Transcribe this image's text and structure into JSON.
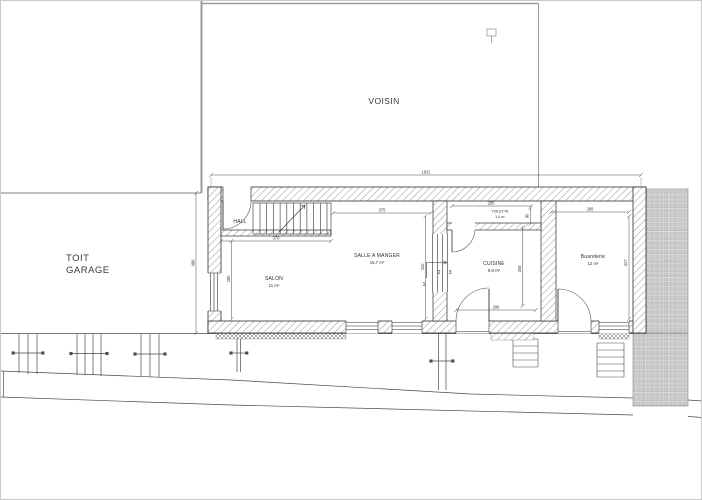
{
  "labels": {
    "voisin": "VOISIN",
    "toit_line1": "TOIT",
    "toit_line2": "GARAGE"
  },
  "rooms": {
    "hall": {
      "name": "HALL"
    },
    "salon": {
      "name": "SALON",
      "area": "11 m²"
    },
    "salle_a_manger": {
      "name": "SALLE A MANGER",
      "area": "15,7 m²"
    },
    "toilette": {
      "name": "TOILETTE",
      "area": "1,4 m²"
    },
    "cuisine": {
      "name": "CUISINE",
      "area": "9,8 m²"
    },
    "buanderie": {
      "name": "Buanderie",
      "area": "12 m²"
    }
  },
  "dims": {
    "total_width": "1931",
    "left_height": "488",
    "hall_bottom": "370",
    "salon_height": "280",
    "salle_top": "375",
    "salle_height": "410",
    "toilette_width": "295",
    "toilette_height": "90",
    "cuisine_width": "296",
    "cuisine_height": "308",
    "buanderie_width": "288",
    "buanderie_height": "417"
  },
  "stairs": {
    "step1": "1",
    "step2": "2",
    "step3": "3"
  },
  "colors": {
    "line": "#3c3c3c",
    "boundary": "#9a9a9a",
    "paving": "#c7c7c7",
    "background": "#ffffff"
  }
}
